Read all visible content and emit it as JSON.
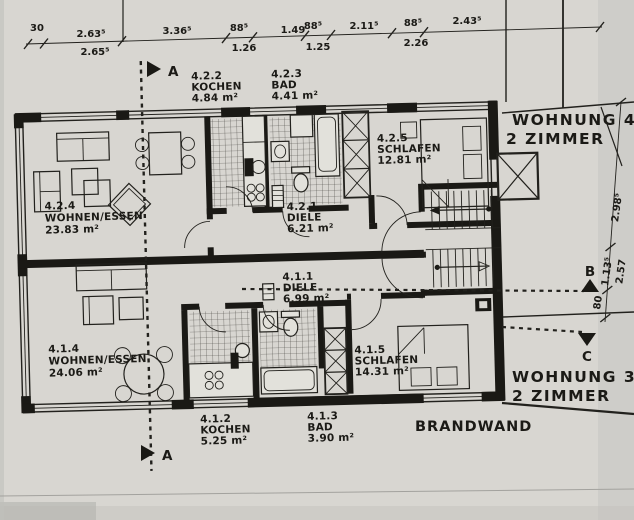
{
  "palette": {
    "paper": "#d8d6d1",
    "ink": "#22211d",
    "wall": "#1a1915",
    "fixture": "#e2e1db"
  },
  "dimensions": {
    "top": [
      {
        "value": "30"
      },
      {
        "value": "2.63⁵",
        "sub": "2.65⁵"
      },
      {
        "value": "3.36⁵"
      },
      {
        "value": "88⁵",
        "sub": "1.26"
      },
      {
        "value": "1.49"
      },
      {
        "value": "88⁵",
        "sub": "1.25"
      },
      {
        "value": "2.11⁵"
      },
      {
        "value": "88⁵",
        "sub": "2.26"
      },
      {
        "value": "2.43⁵"
      }
    ],
    "right": [
      {
        "value": "2.98⁵"
      },
      {
        "value": "1.13⁵",
        "sub": "2.57"
      },
      {
        "value": "80"
      }
    ]
  },
  "rooms": [
    {
      "id": "4.2.2",
      "name": "KOCHEN",
      "area": "4.84 m²"
    },
    {
      "id": "4.2.3",
      "name": "BAD",
      "area": "4.41 m²"
    },
    {
      "id": "4.2.5",
      "name": "SCHLAFEN",
      "area": "12.81 m²"
    },
    {
      "id": "4.2.4",
      "name": "WOHNEN/ESSEN",
      "area": "23.83 m²"
    },
    {
      "id": "4.2.1",
      "name": "DIELE",
      "area": "6.21 m²"
    },
    {
      "id": "4.1.1",
      "name": "DIELE",
      "area": "6.99 m²"
    },
    {
      "id": "4.1.4",
      "name": "WOHNEN/ESSEN",
      "area": "24.06 m²"
    },
    {
      "id": "4.1.5",
      "name": "SCHLAFEN",
      "area": "14.31 m²"
    },
    {
      "id": "4.1.2",
      "name": "KOCHEN",
      "area": "5.25 m²"
    },
    {
      "id": "4.1.3",
      "name": "BAD",
      "area": "3.90 m²"
    }
  ],
  "apartments": [
    {
      "name": "WOHNUNG 4",
      "size": "2 ZIMMER"
    },
    {
      "name": "WOHNUNG 3",
      "size": "2 ZIMMER"
    }
  ],
  "markers": {
    "a": "A",
    "b": "B",
    "c": "C"
  },
  "annotations": {
    "firewall": "BRANDWAND"
  }
}
